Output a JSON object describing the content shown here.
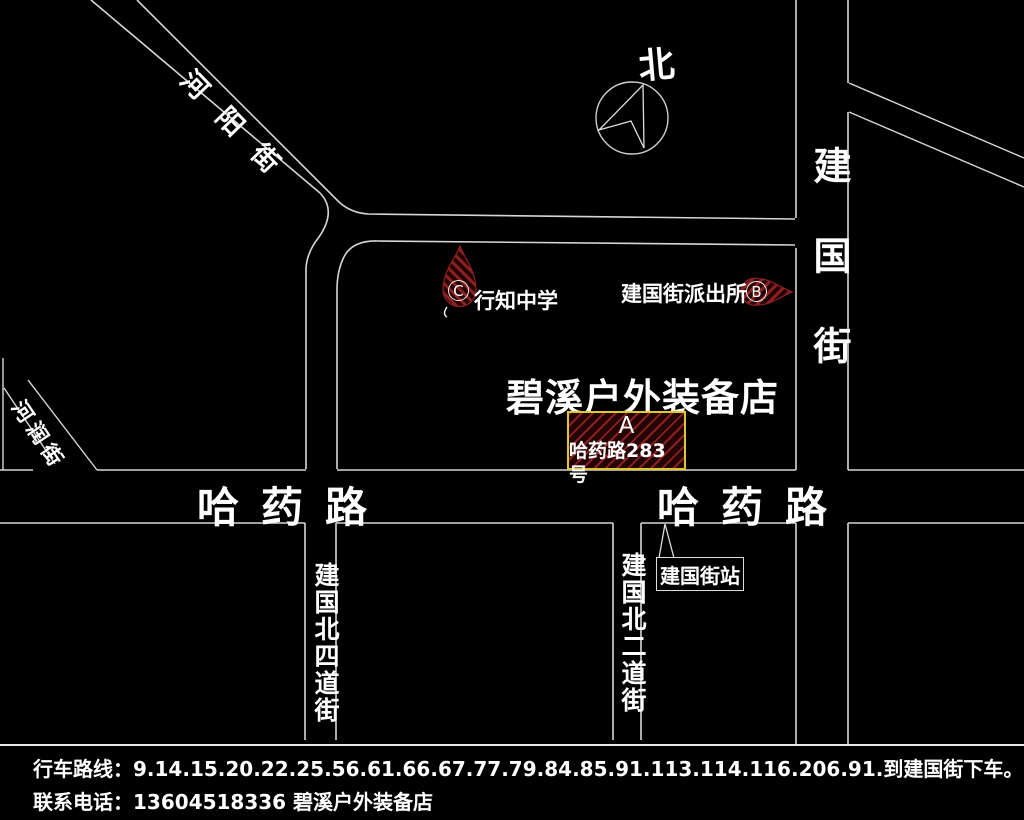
{
  "map": {
    "north_label": "北",
    "streets": {
      "heyang": "河阳街",
      "herun": "河润街",
      "jianguo": "建国街",
      "hayao_left": "哈药路",
      "hayao_right": "哈药路",
      "jianguo_north_4th": "建国北四道街",
      "jianguo_north_2nd": "建国北二道街"
    },
    "pois": {
      "school": {
        "label": "行知中学",
        "marker": "C"
      },
      "police": {
        "label": "建国街派出所",
        "marker": "B"
      },
      "store": {
        "title": "碧溪户外装备店",
        "marker": "A",
        "address": "哈药路283号"
      },
      "station": {
        "label": "建国街站"
      }
    }
  },
  "footer": {
    "route": "行车路线：9.14.15.20.22.25.56.61.66.67.77.79.84.85.91.113.114.116.206.91.到建国街下车。哈药路283号。",
    "contact": "联系电话：13604518336    碧溪户外装备店"
  },
  "colors": {
    "background": "#000000",
    "road_line": "#d6d6d6",
    "marker_red": "#8c1f1f",
    "marker_dark": "#230303",
    "box_border_yellow": "#ddc832",
    "text": "#ffffff"
  }
}
